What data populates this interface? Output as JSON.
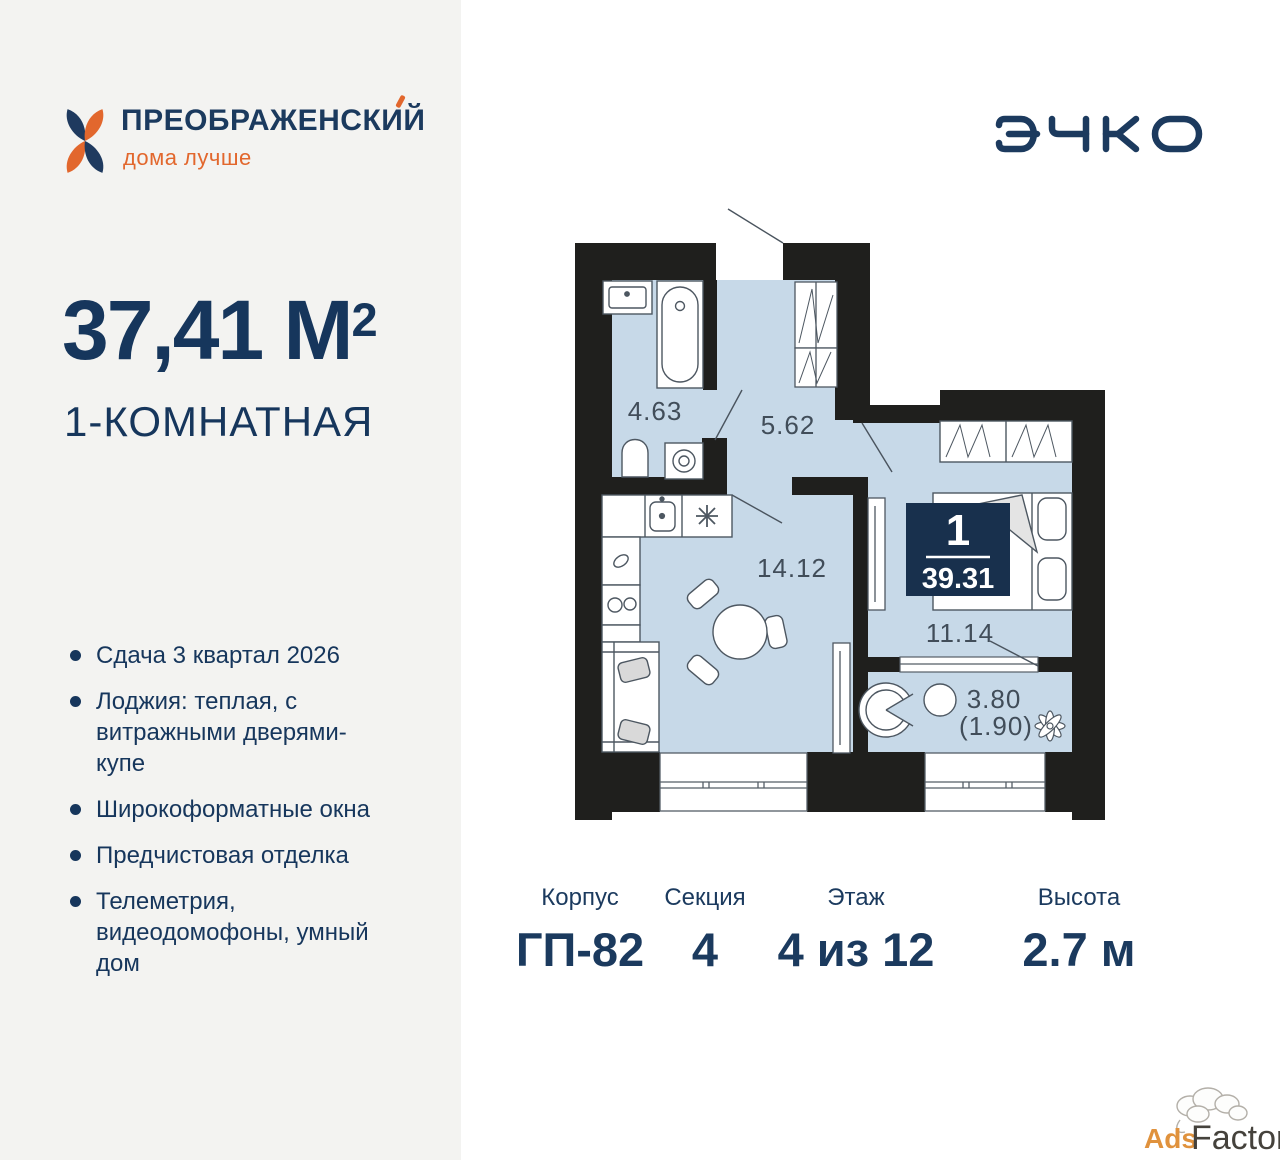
{
  "brand": {
    "name": "ПРЕОБРАЖЕНСКИЙ",
    "tagline": "дома лучше"
  },
  "developer": {
    "name": "ЭНКО"
  },
  "listing": {
    "area_value": "37,41 М",
    "area_superscript": "2",
    "rooms_title": "1-КОМНАТНАЯ",
    "features": [
      "Сдача 3 квартал 2026",
      "Лоджия: теплая, с витражными дверями-купе",
      "Широкоформатные окна",
      "Предчистовая отделка",
      "Телеметрия, видеодомофоны, умный дом"
    ]
  },
  "plan": {
    "room_labels": {
      "bathroom": "4.63",
      "hallway": "5.62",
      "kitchen_living": "14.12",
      "bedroom": "11.14",
      "loggia": "3.80",
      "loggia_secondary": "(1.90)"
    },
    "badge": {
      "rooms_count": "1",
      "total_area": "39.31"
    }
  },
  "details": [
    {
      "label": "Корпус",
      "value": "ГП-82"
    },
    {
      "label": "Секция",
      "value": "4"
    },
    {
      "label": "Этаж",
      "value": "4 из 12"
    },
    {
      "label": "Высота",
      "value": "2.7 м"
    }
  ],
  "watermark": {
    "ads": "Ads",
    "factory": "Factory"
  },
  "colors": {
    "navy": "#1b3a5e",
    "orange": "#e2672d",
    "floor_blue": "#c7d9e8",
    "wall": "#1f1f1d",
    "badge": "#18304d",
    "panel_gray": "#f3f3f1"
  }
}
